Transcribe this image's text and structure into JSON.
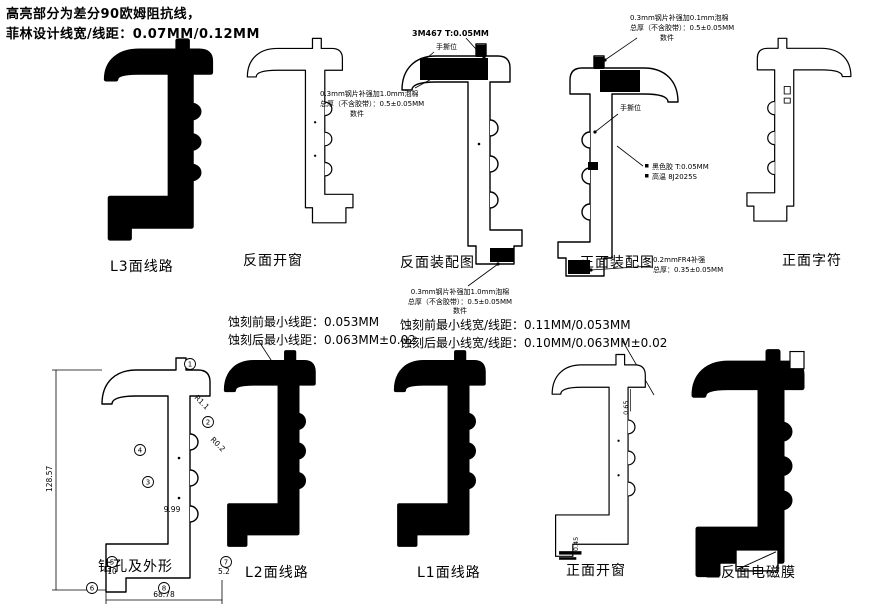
{
  "colors": {
    "line": "#000000",
    "background": "#ffffff"
  },
  "header": {
    "line1": "高亮部分为差分90欧姆阻抗线，",
    "line2": "菲林设计线宽/线距：0.07MM/0.12MM"
  },
  "etch_left": {
    "line1": "蚀刻前最小线距：0.053MM",
    "line2": "蚀刻后最小线距：0.063MM±0.02"
  },
  "etch_right": {
    "line1": "蚀刻前最小线宽/线距：0.11MM/0.053MM",
    "line2": "蚀刻后最小线宽/线距：0.10MM/0.063MM±0.02"
  },
  "figures": {
    "l3": {
      "label": "L3面线路"
    },
    "back_window": {
      "label": "反面开窗"
    },
    "back_assembly": {
      "label": "反面装配图"
    },
    "front_assembly": {
      "label": "正面装配图"
    },
    "front_silkscreen": {
      "label": "正面字符"
    },
    "drill_outline": {
      "label": "钻孔及外形"
    },
    "l2": {
      "label": "L2面线路"
    },
    "l1": {
      "label": "L1面线路"
    },
    "front_window": {
      "label": "正面开窗"
    },
    "emi_film": {
      "label": "正反面电磁膜"
    }
  },
  "annotations": {
    "back_assembly": {
      "adhesive": "3M467 T:0.05MM",
      "tear_tab": "手撕位",
      "stiffener_line1": "0.3mm钢片补强加1.0mm泡棉",
      "stiffener_line2": "总厚（不含胶带）：0.5±0.05MM",
      "stiffener_line3": "数件",
      "bottom_line1": "0.3mm钢片补强加1.0mm泡棉",
      "bottom_line2": "总厚（不含胶带）：0.5±0.05MM",
      "bottom_line3": "数件"
    },
    "front_assembly": {
      "stiffener_line1": "0.3mm钢片补强加0.1mm泡棉",
      "stiffener_line2": "总厚（不含胶带）：0.5±0.05MM",
      "stiffener_line3": "数件",
      "tear_tab": "手撕位",
      "ink_line1": "黑色胶 T:0.05MM",
      "ink_line2": "高温 8J2025S",
      "fr4_line1": "0.2mmFR4补强",
      "fr4_line2": "总厚：0.35±0.05MM"
    }
  },
  "dimensions": {
    "drill_outline": {
      "height": "128.57",
      "width": "68.78",
      "d1": "9.99",
      "d2": "R0.2",
      "d3": "R1.1",
      "d4": "10",
      "d5": "5.2",
      "balloons": [
        "1",
        "2",
        "3",
        "4",
        "5",
        "6",
        "7",
        "8"
      ]
    },
    "front_window": {
      "d1": "0.65",
      "d2": "0.45"
    }
  }
}
